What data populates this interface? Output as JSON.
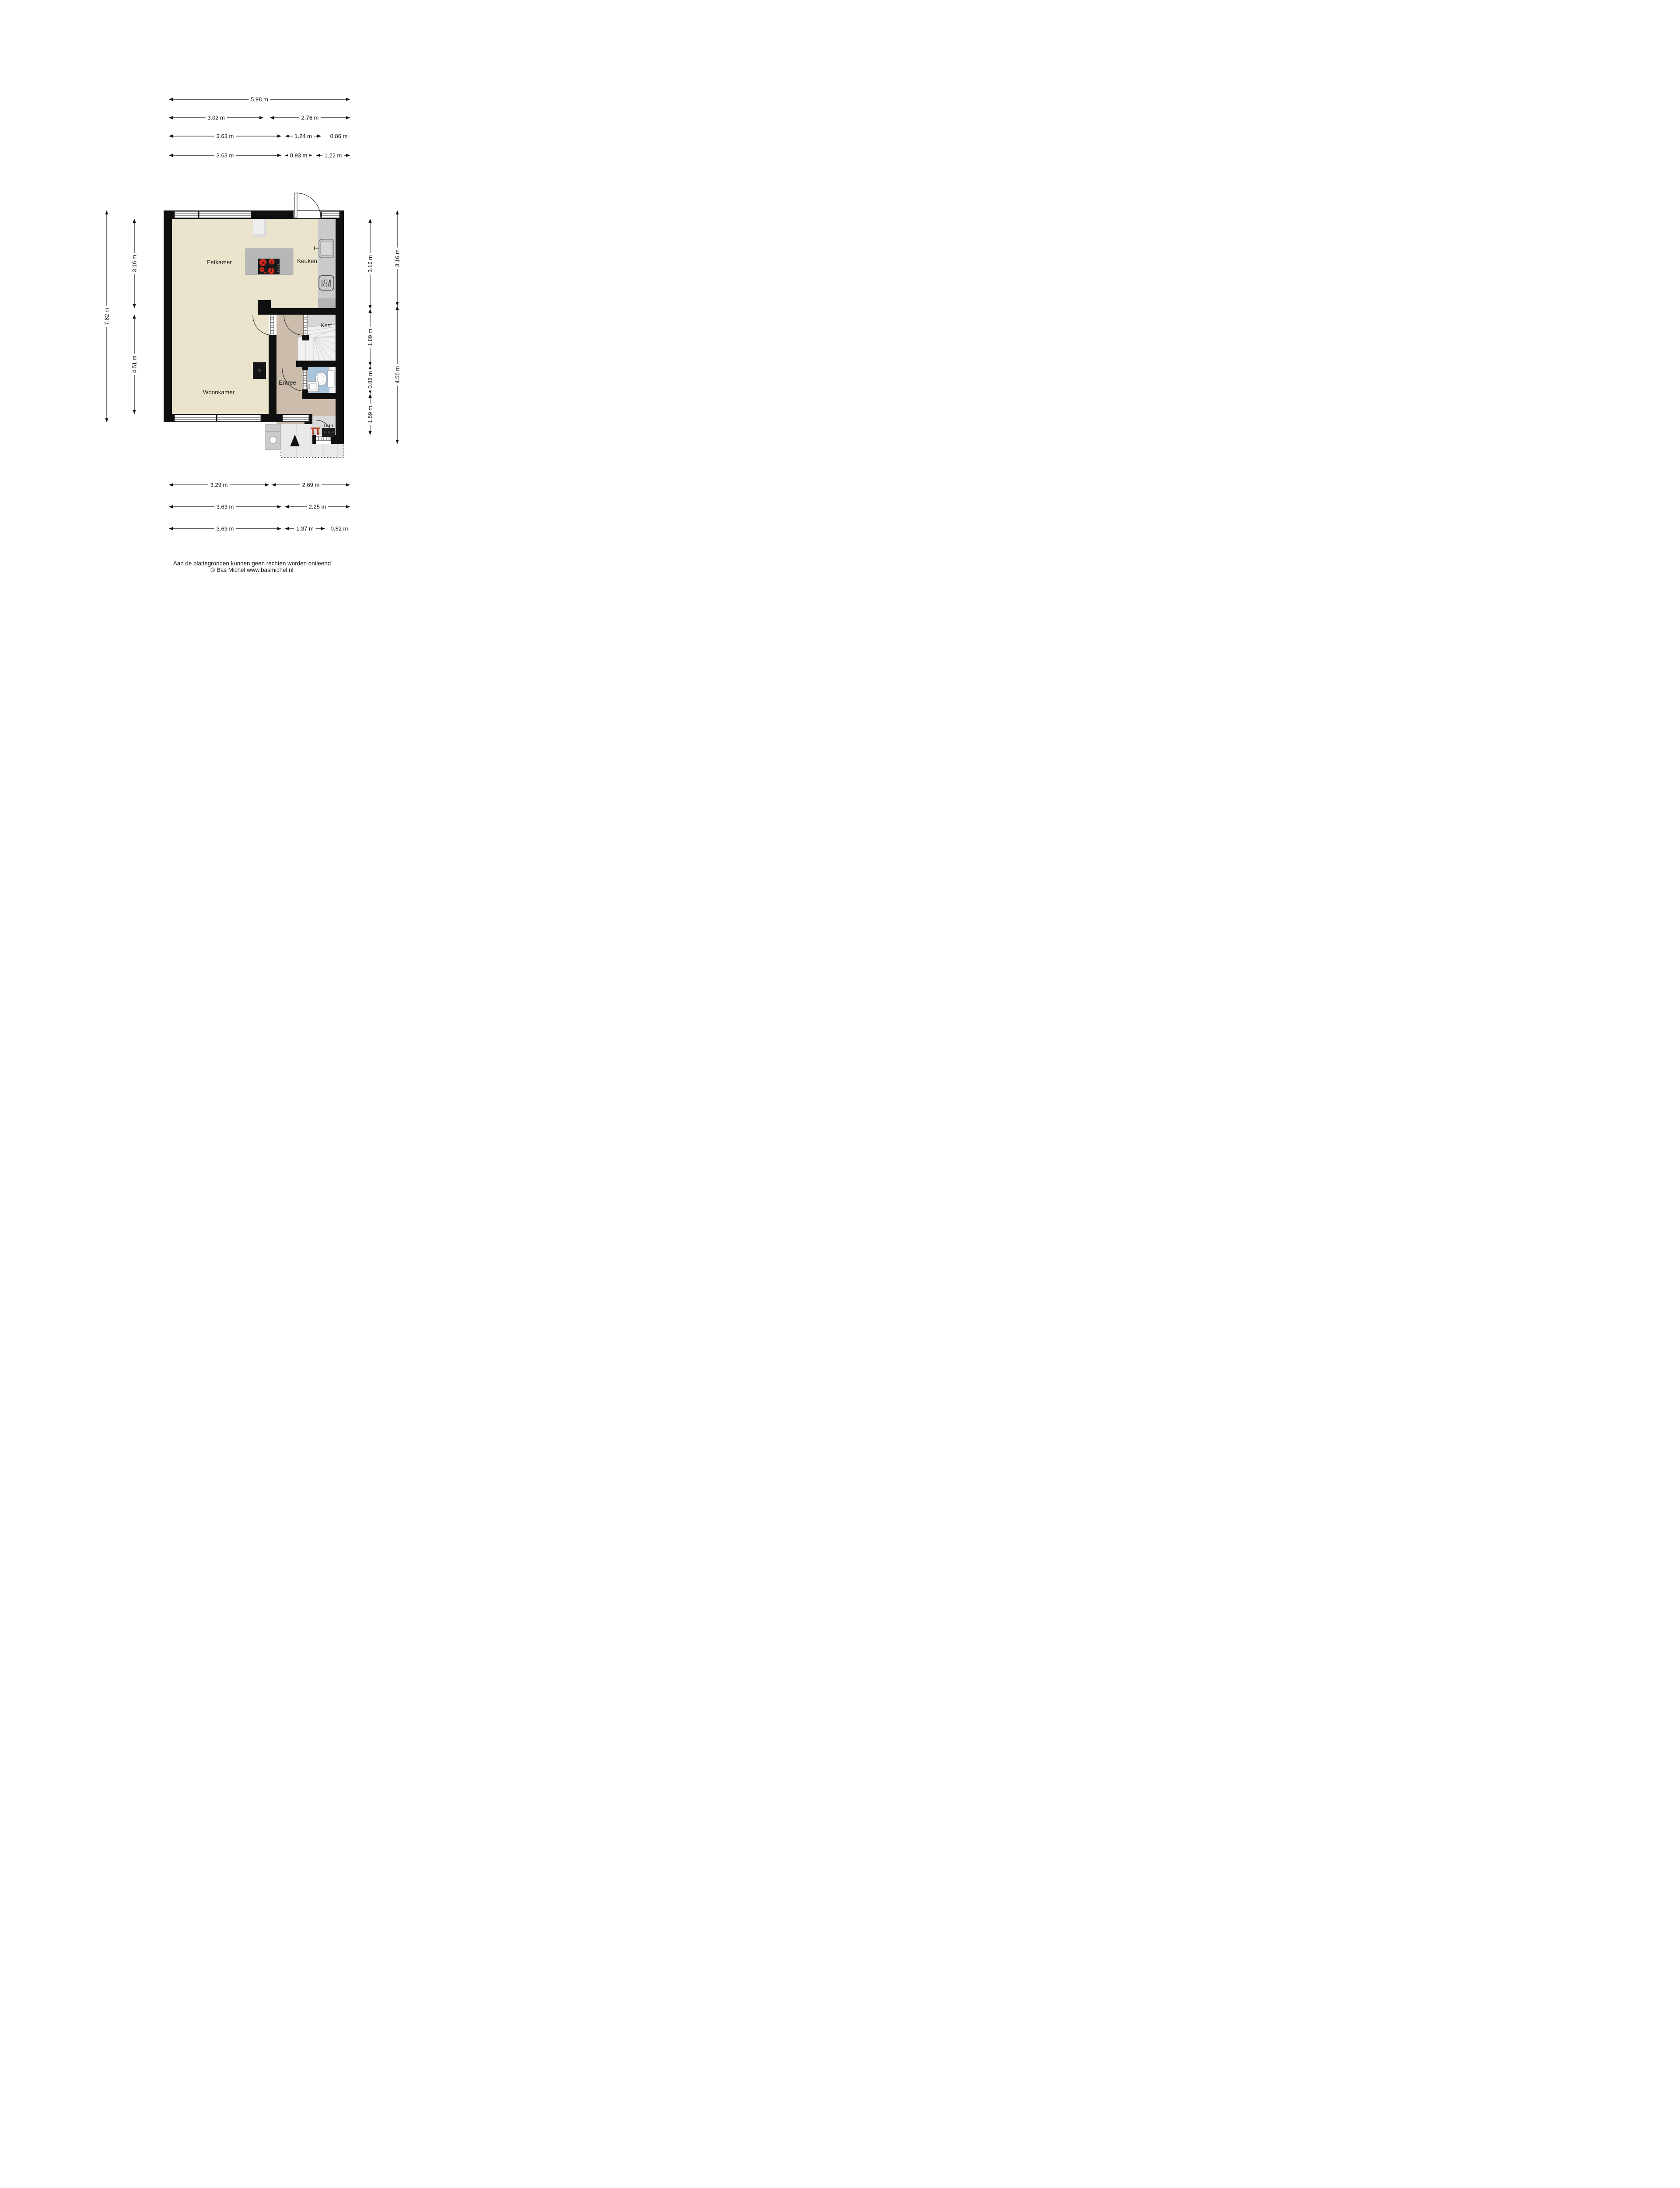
{
  "rooms": {
    "eetkamer": "Eetkamer",
    "keuken": "Keuken",
    "woonkamer": "Woonkamer",
    "entree": "Entree",
    "kast": "Kast"
  },
  "dimensions": {
    "top_rows": [
      [
        "5.98 m"
      ],
      [
        "3.02 m",
        "2.76 m"
      ],
      [
        "3.63 m",
        "1.24 m",
        "0.86 m"
      ],
      [
        "3.63 m",
        "0.93 m",
        "1.22 m"
      ]
    ],
    "bottom_rows": [
      [
        "3.29 m",
        "2.69 m"
      ],
      [
        "3.63 m",
        "2.25 m"
      ],
      [
        "3.63 m",
        "1.37 m",
        "0.82 m"
      ]
    ],
    "left_outer": [
      "7.82 m"
    ],
    "left_inner": [
      "3.16 m",
      "4.51 m"
    ],
    "right_inner": [
      "3.16 m",
      "1.89 m",
      "0.88 m",
      "1.59 m"
    ],
    "right_outer": [
      "3.16 m",
      "4.56 m"
    ]
  },
  "footer": {
    "line1": "Aan de plattegronden kunnen geen rechten worden ontleend",
    "line2": "© Bas Michel www.basmichel.nl"
  },
  "icons": {
    "cooktop": "cooktop-4-burners-icon",
    "kitchen_sink": "kitchen-sink-icon",
    "oven": "oven-icon",
    "toilet": "toilet-icon",
    "washbasin": "washbasin-icon",
    "wood_stove": "wood-stove-icon",
    "coat_hooks": "coat-hooks-icon",
    "meter_cupboard": "meter-cupboard-icon",
    "entrance_arrow": "entrance-arrow-icon",
    "stairs": "winder-stairs"
  },
  "colors": {
    "wall": "#0F0F0F",
    "floor_main": "#EBE4CC",
    "floor_entree": "#CBBCAC",
    "floor_bath": "#A9C4DD",
    "counter": "#CBCBCB",
    "island": "#B7B7B7",
    "stairs": "#F1F1F1",
    "kast": "#D6D6D6",
    "tiles": "#E9E9E9",
    "burner_red": "#CF2B20",
    "hooks_orange": "#B54A2C",
    "ink": "#111111"
  }
}
